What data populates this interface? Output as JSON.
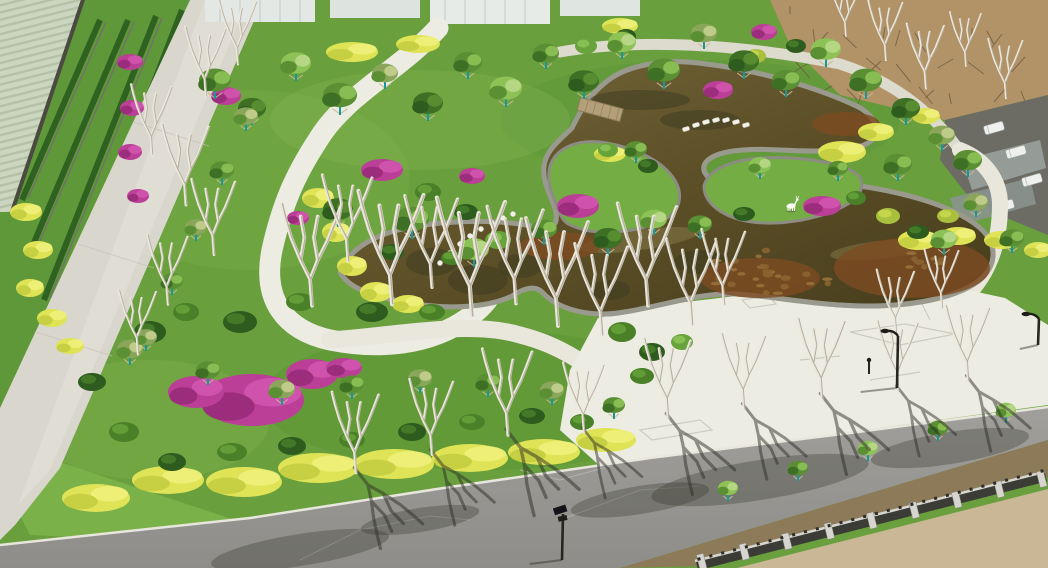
{
  "scene": {
    "type": "aerial-photo",
    "description": "Aerial drone view of a newly built landscaped park: a winding olive-brown pond edged in stone, white curving footpaths and a large white plaza, lawns with yellow hedge ribbons and magenta bougainvillea beds, young trees with teal-painted trunks and bamboo stakes, bare white-barked trees casting shadows on an asphalt road, a lattice boundary fence with stone pillars, farmland at top-left and a bare dirt field at top-right, parked white vans along the upper-right road, black street lamps, and a small white deer sculpture on a grass peninsula.",
    "colors": {
      "lawnBright": "#7cb24a",
      "lawnMid": "#699f3c",
      "canopyMid": "#5a8f33",
      "canopyDark": "#3d7024",
      "canopyLight": "#8cc256",
      "canopyOlive": "#8aa65a",
      "shrubDark": "#2e5c1e",
      "hedgeYellow": "#dfe356",
      "hedgeYellowDark": "#c2cc3e",
      "magenta": "#bb3f97",
      "magentaDark": "#962a78",
      "waterTop": "#77693c",
      "waterMid": "#5f5229",
      "waterDeep": "#463c1c",
      "sediment": "#7d4b22",
      "stone": "#9a998e",
      "stoneDark": "#6f6e64",
      "pathWhite": "#edece2",
      "pathShade": "#dbd9cd",
      "roadLeft": "#d9d6cd",
      "asphalt": "#a09f9b",
      "asphaltDark": "#8e8d89",
      "dirtField": "#b29367",
      "sand": "#c9b795",
      "soil": "#8d7a58",
      "fenceDark": "#3c3c36",
      "fenceLight": "#d6d5cf",
      "wallDark": "#4a4a40",
      "teal": "#15989a",
      "bark": "#ece7db",
      "shadow": "#2e2d26",
      "farmland": "#ccd5c0",
      "farmRow": "#b3c2a6",
      "building": "#e4e8e4",
      "darkRoad": "#6c6c64",
      "vehicleWhite": "#eef0ee",
      "deerWhite": "#fafaf2"
    },
    "landmarks": {
      "deer_statue": "white deer sculpture on grass peninsula",
      "pond": "winding olive-brown ornamental pond with stone edge",
      "plaza": "white paved plaza with etched ground patterns",
      "fence": "boundary fence with stone pillars and dark lattice panels"
    },
    "elements": {
      "deer": {
        "x": 791,
        "y": 206
      },
      "trees": [
        [
          215,
          96,
          16,
          0
        ],
        [
          252,
          122,
          14,
          1
        ],
        [
          296,
          78,
          15,
          2
        ],
        [
          340,
          112,
          17,
          0
        ],
        [
          385,
          86,
          13,
          3
        ],
        [
          428,
          118,
          15,
          1
        ],
        [
          468,
          76,
          14,
          0
        ],
        [
          506,
          104,
          16,
          2
        ],
        [
          546,
          66,
          13,
          0
        ],
        [
          584,
          96,
          15,
          1
        ],
        [
          622,
          56,
          14,
          2
        ],
        [
          664,
          86,
          16,
          0
        ],
        [
          704,
          46,
          13,
          3
        ],
        [
          744,
          76,
          15,
          1
        ],
        [
          786,
          94,
          14,
          0
        ],
        [
          826,
          64,
          15,
          2
        ],
        [
          866,
          96,
          16,
          0
        ],
        [
          906,
          122,
          14,
          1
        ],
        [
          942,
          148,
          13,
          3
        ],
        [
          968,
          174,
          14,
          0
        ],
        [
          338,
          224,
          15,
          1
        ],
        [
          412,
          236,
          17,
          0
        ],
        [
          474,
          264,
          15,
          2
        ],
        [
          544,
          242,
          13,
          0
        ],
        [
          608,
          252,
          14,
          1
        ],
        [
          654,
          232,
          13,
          2
        ],
        [
          700,
          236,
          12,
          0
        ],
        [
          898,
          178,
          14,
          0
        ],
        [
          944,
          252,
          13,
          2
        ],
        [
          976,
          214,
          12,
          3
        ],
        [
          1012,
          250,
          12,
          0
        ],
        [
          636,
          160,
          11,
          0
        ],
        [
          760,
          176,
          11,
          2
        ],
        [
          838,
          178,
          10,
          0
        ],
        [
          130,
          362,
          13,
          3
        ],
        [
          208,
          382,
          12,
          0
        ],
        [
          282,
          402,
          13,
          3
        ],
        [
          352,
          396,
          12,
          0
        ],
        [
          420,
          390,
          12,
          3
        ],
        [
          488,
          394,
          12,
          0
        ],
        [
          552,
          402,
          12,
          3
        ],
        [
          614,
          416,
          11,
          0
        ],
        [
          246,
          128,
          12,
          3
        ],
        [
          222,
          182,
          12,
          0
        ],
        [
          196,
          238,
          11,
          3
        ],
        [
          172,
          292,
          11,
          0
        ],
        [
          146,
          348,
          11,
          3
        ],
        [
          728,
          498,
          10,
          2
        ],
        [
          798,
          478,
          10,
          0
        ],
        [
          868,
          458,
          10,
          2
        ],
        [
          938,
          438,
          10,
          0
        ],
        [
          1006,
          420,
          10,
          2
        ]
      ],
      "bareTrees": [
        [
          312,
          302,
          1.9,
          0
        ],
        [
          348,
          258,
          1.6,
          0
        ],
        [
          392,
          300,
          2.1,
          0
        ],
        [
          432,
          284,
          1.7,
          0
        ],
        [
          472,
          312,
          2.2,
          0
        ],
        [
          516,
          300,
          1.8,
          0
        ],
        [
          558,
          322,
          2.0,
          0
        ],
        [
          602,
          332,
          1.7,
          0
        ],
        [
          648,
          302,
          1.9,
          0
        ],
        [
          692,
          322,
          1.6,
          0
        ],
        [
          724,
          302,
          1.4,
          0
        ],
        [
          152,
          152,
          1.3,
          0
        ],
        [
          186,
          202,
          1.5,
          0
        ],
        [
          214,
          252,
          1.4,
          0
        ],
        [
          168,
          302,
          1.3,
          0
        ],
        [
          138,
          352,
          1.2,
          0
        ],
        [
          238,
          62,
          1.2,
          0
        ],
        [
          206,
          94,
          1.3,
          0
        ],
        [
          886,
          58,
          1.1,
          0
        ],
        [
          926,
          86,
          1.2,
          0
        ],
        [
          966,
          64,
          1.0,
          0
        ],
        [
          1006,
          96,
          1.1,
          0
        ],
        [
          846,
          34,
          1.0,
          0
        ],
        [
          356,
          470,
          1.5,
          1
        ],
        [
          432,
          452,
          1.4,
          1
        ],
        [
          508,
          432,
          1.6,
          1
        ],
        [
          584,
          430,
          1.3,
          1
        ],
        [
          668,
          416,
          1.5,
          1
        ],
        [
          744,
          406,
          1.4,
          1
        ],
        [
          822,
          396,
          1.5,
          1
        ],
        [
          898,
          388,
          1.3,
          1
        ],
        [
          968,
          378,
          1.4,
          1
        ],
        [
          896,
          332,
          1.2,
          0
        ],
        [
          942,
          306,
          1.1,
          0
        ]
      ],
      "shrubs": [
        [
          150,
          332,
          16,
          11,
          0
        ],
        [
          186,
          312,
          13,
          9,
          1
        ],
        [
          240,
          322,
          17,
          11,
          0
        ],
        [
          300,
          302,
          14,
          9,
          1
        ],
        [
          372,
          312,
          16,
          10,
          0
        ],
        [
          432,
          312,
          13,
          8,
          1
        ],
        [
          92,
          382,
          14,
          9,
          0
        ],
        [
          124,
          432,
          15,
          10,
          1
        ],
        [
          172,
          462,
          14,
          9,
          0
        ],
        [
          232,
          452,
          15,
          9,
          1
        ],
        [
          292,
          446,
          14,
          9,
          0
        ],
        [
          352,
          440,
          13,
          8,
          1
        ],
        [
          412,
          432,
          14,
          9,
          0
        ],
        [
          472,
          422,
          13,
          8,
          1
        ],
        [
          532,
          416,
          13,
          8,
          0
        ],
        [
          582,
          422,
          12,
          8,
          1
        ],
        [
          428,
          192,
          13,
          9,
          1
        ],
        [
          466,
          212,
          12,
          8,
          0
        ],
        [
          498,
          240,
          13,
          9,
          2
        ],
        [
          452,
          258,
          11,
          7,
          1
        ],
        [
          392,
          252,
          12,
          8,
          0
        ],
        [
          622,
          332,
          14,
          10,
          1
        ],
        [
          652,
          352,
          13,
          9,
          0
        ],
        [
          642,
          376,
          12,
          8,
          1
        ],
        [
          682,
          342,
          11,
          8,
          2
        ],
        [
          888,
          216,
          12,
          8,
          3
        ],
        [
          918,
          232,
          11,
          7,
          0
        ],
        [
          948,
          216,
          11,
          7,
          3
        ],
        [
          744,
          214,
          11,
          7,
          0
        ],
        [
          856,
          198,
          10,
          7,
          1
        ],
        [
          608,
          150,
          10,
          7,
          2
        ],
        [
          648,
          166,
          10,
          7,
          0
        ],
        [
          702,
          506,
          11,
          8,
          3
        ],
        [
          762,
          490,
          11,
          8,
          0
        ],
        [
          816,
          472,
          11,
          8,
          3
        ],
        [
          872,
          454,
          10,
          7,
          0
        ],
        [
          932,
          442,
          10,
          7,
          3
        ],
        [
          992,
          426,
          10,
          7,
          0
        ],
        [
          1038,
          416,
          9,
          7,
          3
        ],
        [
          586,
          46,
          11,
          8,
          2
        ],
        [
          626,
          36,
          10,
          7,
          0
        ],
        [
          756,
          56,
          10,
          7,
          3
        ],
        [
          796,
          46,
          10,
          7,
          0
        ]
      ],
      "magentaPatches": [
        [
          252,
          400,
          52,
          26
        ],
        [
          196,
          392,
          28,
          16
        ],
        [
          312,
          374,
          26,
          15
        ],
        [
          344,
          368,
          18,
          10
        ],
        [
          226,
          96,
          15,
          9
        ],
        [
          130,
          62,
          13,
          8
        ],
        [
          132,
          108,
          12,
          8
        ],
        [
          130,
          152,
          12,
          8
        ],
        [
          138,
          196,
          11,
          7
        ],
        [
          382,
          170,
          21,
          11
        ],
        [
          578,
          206,
          21,
          12
        ],
        [
          822,
          206,
          19,
          10
        ],
        [
          718,
          90,
          15,
          9
        ],
        [
          472,
          176,
          13,
          8
        ],
        [
          764,
          32,
          13,
          8
        ],
        [
          298,
          218,
          11,
          7
        ]
      ],
      "yellowPatches": [
        [
          96,
          498,
          34,
          14
        ],
        [
          168,
          480,
          36,
          14
        ],
        [
          244,
          482,
          38,
          15
        ],
        [
          318,
          468,
          40,
          15
        ],
        [
          394,
          464,
          40,
          15
        ],
        [
          470,
          458,
          38,
          14
        ],
        [
          544,
          452,
          36,
          13
        ],
        [
          606,
          440,
          30,
          12
        ],
        [
          318,
          198,
          16,
          10
        ],
        [
          336,
          232,
          14,
          10
        ],
        [
          352,
          266,
          15,
          10
        ],
        [
          376,
          292,
          16,
          10
        ],
        [
          408,
          304,
          16,
          9
        ],
        [
          26,
          212,
          16,
          9
        ],
        [
          38,
          250,
          15,
          9
        ],
        [
          30,
          288,
          14,
          9
        ],
        [
          52,
          318,
          15,
          9
        ],
        [
          70,
          346,
          14,
          8
        ],
        [
          352,
          52,
          26,
          10
        ],
        [
          418,
          44,
          22,
          9
        ],
        [
          620,
          26,
          18,
          8
        ],
        [
          842,
          152,
          24,
          11
        ],
        [
          876,
          132,
          18,
          9
        ],
        [
          918,
          240,
          20,
          10
        ],
        [
          958,
          236,
          18,
          9
        ],
        [
          1002,
          240,
          18,
          9
        ],
        [
          1038,
          250,
          14,
          8
        ],
        [
          610,
          154,
          16,
          8
        ],
        [
          926,
          116,
          14,
          8
        ]
      ],
      "steppingStones": [
        [
          686,
          129
        ],
        [
          696,
          125
        ],
        [
          706,
          122
        ],
        [
          716,
          120
        ],
        [
          726,
          120
        ],
        [
          736,
          122
        ],
        [
          746,
          125
        ]
      ],
      "gardenStones": [
        [
          440,
          263
        ],
        [
          450,
          253
        ],
        [
          460,
          244
        ],
        [
          470,
          236
        ],
        [
          481,
          229
        ],
        [
          492,
          223
        ],
        [
          503,
          218
        ],
        [
          513,
          214
        ]
      ],
      "lamps": [
        {
          "x": 897,
          "y": 388,
          "h": 52,
          "type": "curve"
        },
        {
          "x": 562,
          "y": 560,
          "h": 46,
          "type": "panel"
        },
        {
          "x": 1038,
          "y": 345,
          "h": 26,
          "type": "curve"
        },
        {
          "x": 869,
          "y": 374,
          "h": 14,
          "type": "bollard"
        }
      ],
      "vehicles": [
        [
          994,
          128
        ],
        [
          1016,
          152
        ],
        [
          1032,
          180
        ],
        [
          1004,
          206
        ]
      ],
      "reflections": [
        [
          432,
          262,
          26,
          14
        ],
        [
          478,
          280,
          30,
          15
        ],
        [
          520,
          266,
          22,
          12
        ],
        [
          700,
          262,
          26,
          12
        ],
        [
          610,
          290,
          20,
          10
        ],
        [
          640,
          100,
          50,
          10
        ],
        [
          700,
          120,
          40,
          10
        ]
      ],
      "sedimentBlobs": [
        [
          912,
          268,
          78,
          30
        ],
        [
          760,
          278,
          60,
          20
        ],
        [
          560,
          246,
          40,
          14
        ],
        [
          846,
          124,
          34,
          12
        ]
      ],
      "roadShadowBlobs": [
        [
          300,
          550,
          90,
          16
        ],
        [
          420,
          520,
          60,
          12
        ],
        [
          760,
          480,
          110,
          20
        ],
        [
          950,
          448,
          80,
          16
        ],
        [
          640,
          500,
          70,
          14
        ]
      ]
    }
  }
}
